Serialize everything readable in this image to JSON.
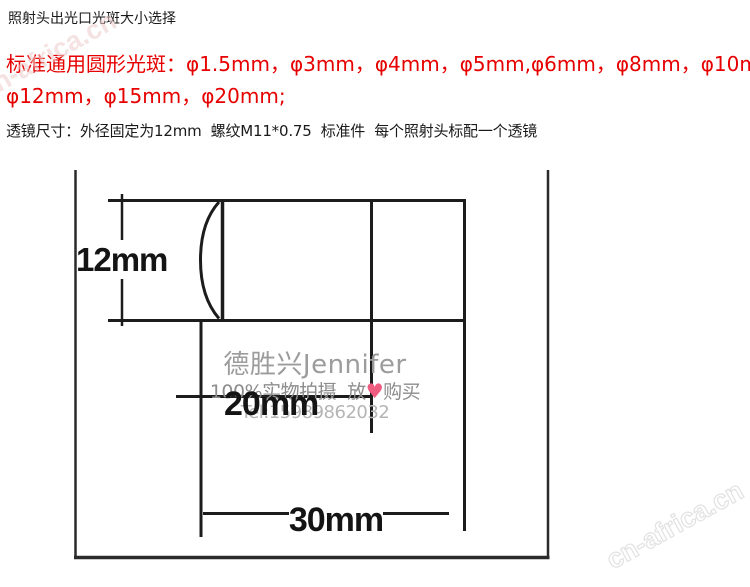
{
  "header": {
    "title": "照射头出光口光斑大小选择",
    "spot_label_line1": "标准通用圆形光斑：φ1.5mm，φ3mm，φ4mm，φ5mm,φ6mm，φ8mm，φ10mm，",
    "spot_label_line2": "φ12mm，φ15mm，φ20mm;",
    "lens_spec": "透镜尺寸：外径固定为12mm  螺纹M11*0.75  标准件  每个照射头标配一个透镜",
    "red_color": "#e60000"
  },
  "diagram": {
    "dim_lens_diameter": "12mm",
    "dim_thread_length": "20mm",
    "dim_total_length": "30mm"
  },
  "watermark": {
    "shop_name": "德胜兴Jennifer",
    "slogan_prefix": "100%实物拍摄  放",
    "heart_icon": "♥",
    "slogan_suffix": "购买",
    "phone": "Tel:15989862032",
    "site": "cn-africa.cn",
    "heart_color": "#ee5d80"
  }
}
